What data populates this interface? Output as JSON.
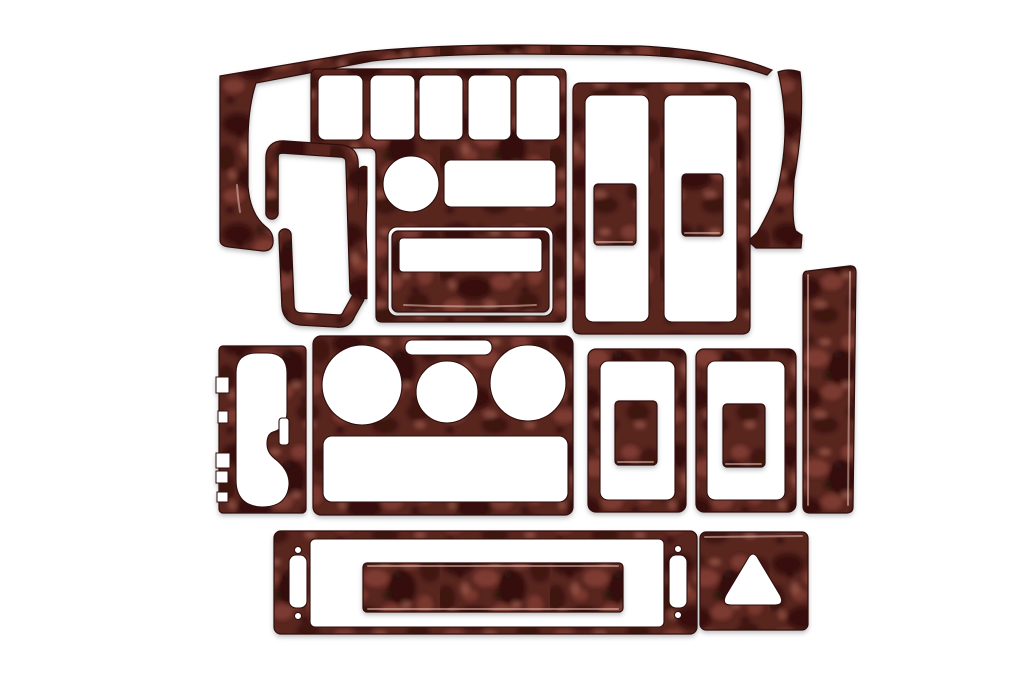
{
  "meta": {
    "type": "product-photo",
    "subject": "Glossy dark burl wood automotive dash trim kit laid out on a white background",
    "visible_piece_count": 20
  },
  "palette": {
    "background": "#ffffff",
    "wood_base": "#58251f",
    "wood_dark": "#1f0a08",
    "wood_mid": "#8a4136",
    "wood_light": "#b06a58",
    "edge": "#2e100c",
    "sheen": "#e7c0b2"
  },
  "pieces": [
    {
      "id": 1,
      "name": "windshield-top-trim-with-left-end-cap"
    },
    {
      "id": 2,
      "name": "right-pillar-trim"
    },
    {
      "id": 3,
      "name": "main-dash-panel-five-switch-openings"
    },
    {
      "id": 4,
      "name": "radio-surround-insert"
    },
    {
      "id": 5,
      "name": "upper-door-pull-trim"
    },
    {
      "id": 6,
      "name": "lower-door-pull-trim"
    },
    {
      "id": 7,
      "name": "vertical-accent-strip"
    },
    {
      "id": 8,
      "name": "double-window-switch-frame"
    },
    {
      "id": 9,
      "name": "switch-button-insert-left"
    },
    {
      "id": 10,
      "name": "switch-button-insert-right"
    },
    {
      "id": 11,
      "name": "side-vertical-plank"
    },
    {
      "id": 12,
      "name": "shifter-console-panel"
    },
    {
      "id": 13,
      "name": "climate-control-panel"
    },
    {
      "id": 14,
      "name": "window-switch-frame-left"
    },
    {
      "id": 15,
      "name": "window-switch-insert-left"
    },
    {
      "id": 16,
      "name": "window-switch-frame-right"
    },
    {
      "id": 17,
      "name": "window-switch-insert-right"
    },
    {
      "id": 18,
      "name": "lower-vent-frame"
    },
    {
      "id": 19,
      "name": "vent-slat-insert"
    },
    {
      "id": 20,
      "name": "hazard-switch-plate"
    }
  ]
}
